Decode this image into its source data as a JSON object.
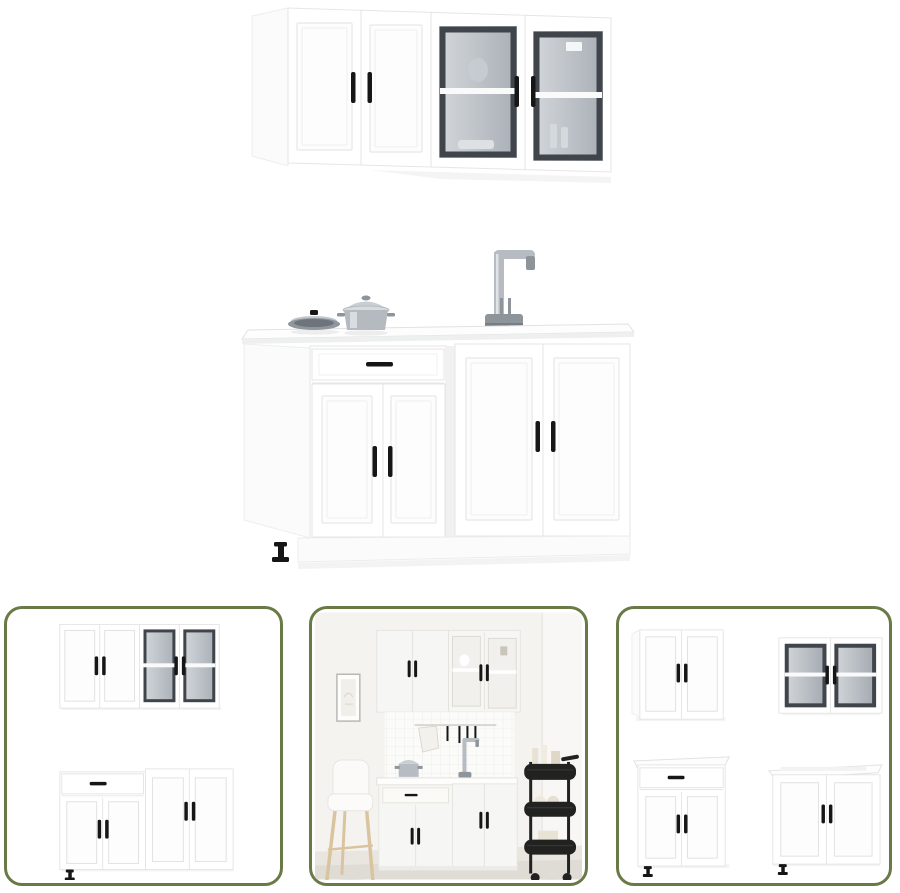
{
  "page": {
    "background": "#ffffff",
    "description": "Product image collage of a white four-piece kitchen cabinet set"
  },
  "colors": {
    "thumbnail_border": "#697a47",
    "cabinet_white": "#ffffff",
    "cabinet_line": "#e6e6e6",
    "panel_line": "#e2e2e2",
    "handle_black": "#161616",
    "glass_frame_dark": "#40454b",
    "glass_light": "#ccd1d6",
    "glass_deep": "#9aa1a8",
    "steel": "#b6bcc1",
    "steel_dark": "#8d949a",
    "shadow": "#f1f1f1",
    "scene_wall": "#f4f3f0",
    "scene_floor": "#e9e6e0",
    "scene_rug": "#dfdcd6",
    "wood": "#d9c49f",
    "cart_black": "#222220"
  },
  "main_image": {
    "alt": "White kitchen wall cabinet with two panel doors and two glass doors, above a white base cabinet unit with drawer, four doors, black handles, cookware and a steel kitchen faucet"
  },
  "thumbnails": [
    {
      "alt": "Front view of the kitchen cabinet set: wall cabinets with glass doors above two base cabinets"
    },
    {
      "alt": "Kitchen cabinet set staged in a room with bar stool, tiled backsplash, utensil rail and black serving trolley"
    },
    {
      "alt": "The four cabinets shown individually: panel-door wall cabinet, glass-door wall cabinet, drawer base cabinet and sink base cabinet"
    }
  ]
}
